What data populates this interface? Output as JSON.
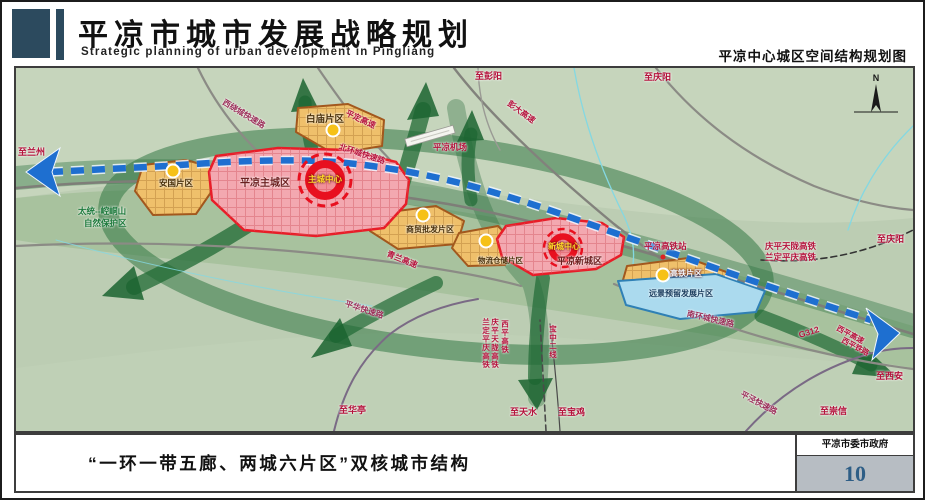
{
  "header": {
    "title": "平凉市城市发展战略规划",
    "subtitle": "Strategic planning of urban development in Pingliang",
    "map_title": "平凉中心城区空间结构规划图"
  },
  "footer": {
    "caption": "“一环一带五廊、两城六片区”双核城市结构",
    "agency": "平凉市委市政府",
    "page": "10"
  },
  "colors": {
    "header_block": "#2c4a5e",
    "map_base_green": "#bccdb3",
    "corridor_green": "#2e7d46",
    "axis_blue": "#1e6fd0",
    "zone_red_fill": "#f3a8b0",
    "zone_red_stroke": "#e81d28",
    "zone_orange_fill": "#efc06b",
    "zone_orange_stroke": "#a2571d",
    "zone_blue_fill": "#abdaee",
    "node_yellow": "#f6c117",
    "road_label_red": "#b5123c",
    "page_number": "#2e5e86"
  },
  "map": {
    "compass_n": "N",
    "labels": [
      {
        "text": "至兰州",
        "x": 2,
        "y": 80,
        "c": "#b5123c",
        "s": 9
      },
      {
        "text": "西绕城快速路",
        "x": 207,
        "y": 30,
        "r": 31,
        "c": "#9c2f5a",
        "s": 8
      },
      {
        "text": "平定高速",
        "x": 330,
        "y": 41,
        "r": 25,
        "c": "#b5123c",
        "s": 8
      },
      {
        "text": "北环城快速路",
        "x": 323,
        "y": 75,
        "r": 18,
        "c": "#b5123c",
        "s": 8
      },
      {
        "text": "至彭阳",
        "x": 459,
        "y": 4,
        "c": "#b5123c",
        "s": 9
      },
      {
        "text": "彭大高速",
        "x": 492,
        "y": 31,
        "r": 36,
        "c": "#b5123c",
        "s": 8
      },
      {
        "text": "至庆阳",
        "x": 628,
        "y": 5,
        "c": "#b5123c",
        "s": 9
      },
      {
        "text": "白庙片区",
        "x": 290,
        "y": 47,
        "c": "#4a3008",
        "s": 9.5
      },
      {
        "text": "平凉机场",
        "x": 417,
        "y": 75,
        "c": "#b5123c",
        "s": 8.5
      },
      {
        "text": "安国片区",
        "x": 143,
        "y": 111,
        "c": "#4a3008",
        "s": 8.5
      },
      {
        "text": "平凉主城区",
        "x": 224,
        "y": 111,
        "c": "#6b1f1f",
        "s": 10
      },
      {
        "text": "主城中心",
        "x": 292,
        "y": 107,
        "c": "#ffd92a",
        "s": 8.5,
        "sh": "dark"
      },
      {
        "text": "太统--崆峒山",
        "x": 62,
        "y": 139,
        "c": "#1d7a3c",
        "s": 8.5
      },
      {
        "text": "自然保护区",
        "x": 68,
        "y": 151,
        "c": "#1d7a3c",
        "s": 8.5
      },
      {
        "text": "商贸批发片区",
        "x": 390,
        "y": 158,
        "c": "#4a3008",
        "s": 8
      },
      {
        "text": "青兰高速",
        "x": 371,
        "y": 182,
        "r": 22,
        "c": "#b5123c",
        "s": 8
      },
      {
        "text": "物流仓储片区",
        "x": 462,
        "y": 189,
        "c": "#4a3008",
        "s": 7.5
      },
      {
        "text": "新城中心",
        "x": 532,
        "y": 175,
        "c": "#ffd92a",
        "s": 8,
        "sh": "dark"
      },
      {
        "text": "平凉新城区",
        "x": 541,
        "y": 189,
        "c": "#6b1f1f",
        "s": 9
      },
      {
        "text": "平凉高铁站",
        "x": 628,
        "y": 174,
        "c": "#b5123c",
        "s": 8.5
      },
      {
        "text": "庆平天陇高铁",
        "x": 749,
        "y": 174,
        "c": "#b5123c",
        "s": 8.5
      },
      {
        "text": "兰定平庆高铁",
        "x": 749,
        "y": 185,
        "c": "#b5123c",
        "s": 8.5
      },
      {
        "text": "至庆阳",
        "x": 861,
        "y": 167,
        "c": "#b5123c",
        "s": 9
      },
      {
        "text": "高铁片区",
        "x": 654,
        "y": 202,
        "c": "#f2f8fc",
        "s": 8,
        "sh": "dark"
      },
      {
        "text": "远景预留发展片区",
        "x": 633,
        "y": 222,
        "c": "#173a5c",
        "s": 8
      },
      {
        "text": "南环城快速路",
        "x": 671,
        "y": 242,
        "r": 13,
        "c": "#9c2f5a",
        "s": 8
      },
      {
        "text": "G312",
        "x": 783,
        "y": 263,
        "r": -17,
        "c": "#b5123c",
        "s": 8.5
      },
      {
        "text": "西平高速",
        "x": 821,
        "y": 256,
        "r": 28,
        "c": "#b5123c",
        "s": 7.5
      },
      {
        "text": "西平铁路",
        "x": 826,
        "y": 268,
        "r": 28,
        "c": "#b5123c",
        "s": 7.5
      },
      {
        "text": "至西安",
        "x": 860,
        "y": 304,
        "c": "#b5123c",
        "s": 9
      },
      {
        "text": "平华快速路",
        "x": 329,
        "y": 232,
        "r": 18,
        "c": "#9c2f5a",
        "s": 8
      },
      {
        "text": "兰定平庆高铁",
        "x": 466,
        "y": 250,
        "v": true,
        "c": "#b5123c",
        "s": 7.5
      },
      {
        "text": "庆平天陇高铁",
        "x": 475,
        "y": 250,
        "v": true,
        "c": "#b5123c",
        "s": 7.5
      },
      {
        "text": "西平高铁",
        "x": 485,
        "y": 252,
        "v": true,
        "c": "#b5123c",
        "s": 7.5
      },
      {
        "text": "宝中二线",
        "x": 533,
        "y": 257,
        "v": true,
        "c": "#b5123c",
        "s": 7.5
      },
      {
        "text": "至华亭",
        "x": 323,
        "y": 338,
        "c": "#b5123c",
        "s": 9
      },
      {
        "text": "至天水",
        "x": 494,
        "y": 340,
        "c": "#b5123c",
        "s": 9
      },
      {
        "text": "至宝鸡",
        "x": 542,
        "y": 340,
        "c": "#b5123c",
        "s": 9
      },
      {
        "text": "至崇信",
        "x": 804,
        "y": 339,
        "c": "#b5123c",
        "s": 9
      },
      {
        "text": "平泾快速路",
        "x": 725,
        "y": 322,
        "r": 28,
        "c": "#9c2f5a",
        "s": 8
      }
    ]
  }
}
